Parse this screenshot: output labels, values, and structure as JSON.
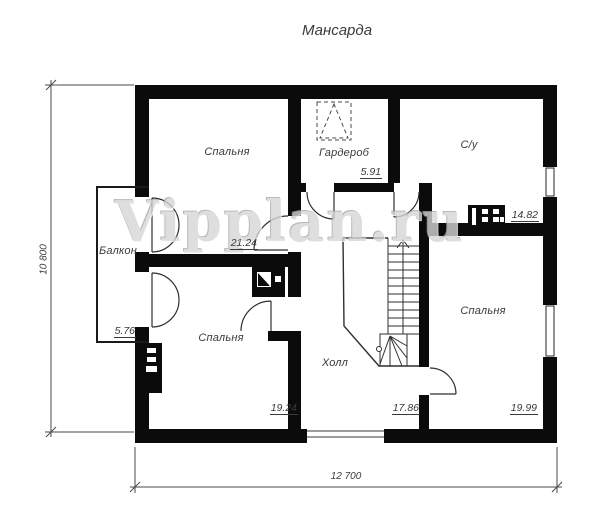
{
  "title": "Мансарда",
  "watermark": "Vipplan.ru",
  "rooms": [
    {
      "name": "Спальня",
      "area": "21.24"
    },
    {
      "name": "Гардероб",
      "area": "5.91"
    },
    {
      "name": "С/у",
      "area": "14.82"
    },
    {
      "name": "Балкон",
      "area": "5.76"
    },
    {
      "name": "Спальня",
      "area": "19.24"
    },
    {
      "name": "Холл",
      "area": "17.86"
    },
    {
      "name": "Спальня",
      "area": "19.99"
    }
  ],
  "dimensions": {
    "total_width": "12 700",
    "total_height": "10 800"
  },
  "colors": {
    "wall": "#0b0b0b",
    "line": "#2f2f2f",
    "label": "#3a3a3a",
    "watermark": "#d6d6d6",
    "background": "#ffffff"
  }
}
